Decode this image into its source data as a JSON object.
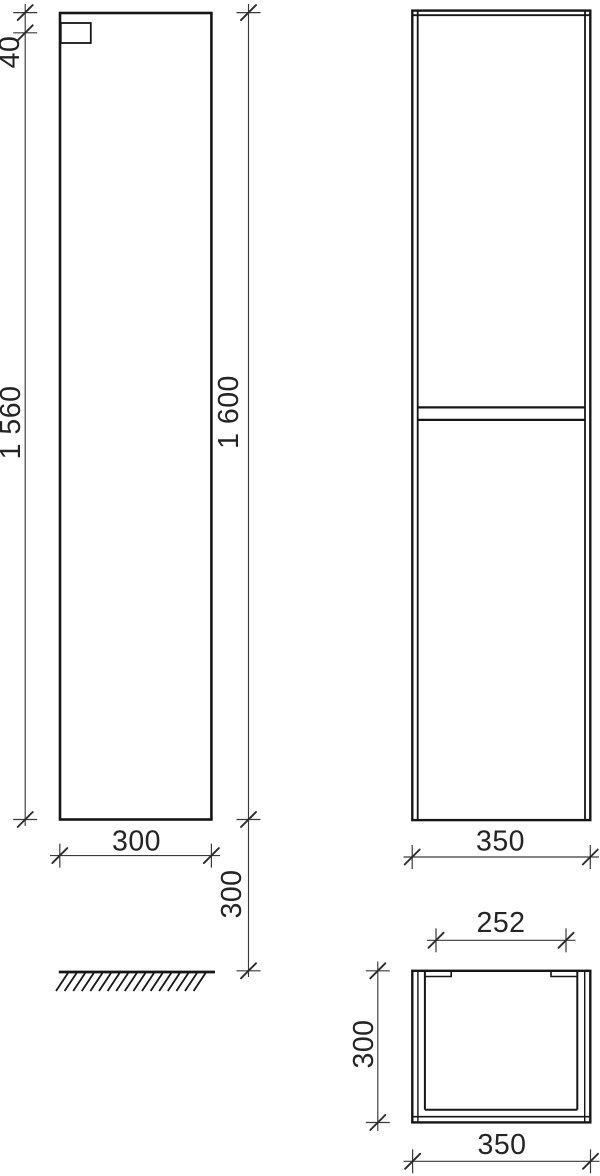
{
  "drawing": {
    "line_color": "#161616",
    "dimension_color": "#3a3a3a",
    "text_color": "#242424",
    "background_color": "#ffffff"
  },
  "dimensions": {
    "top_offset": "40",
    "body_height": "1 560",
    "total_height": "1 600",
    "side_depth": "300",
    "floor_clearance": "300",
    "front_width": "350",
    "opening_width": "252",
    "top_depth": "300",
    "top_width": "350"
  }
}
